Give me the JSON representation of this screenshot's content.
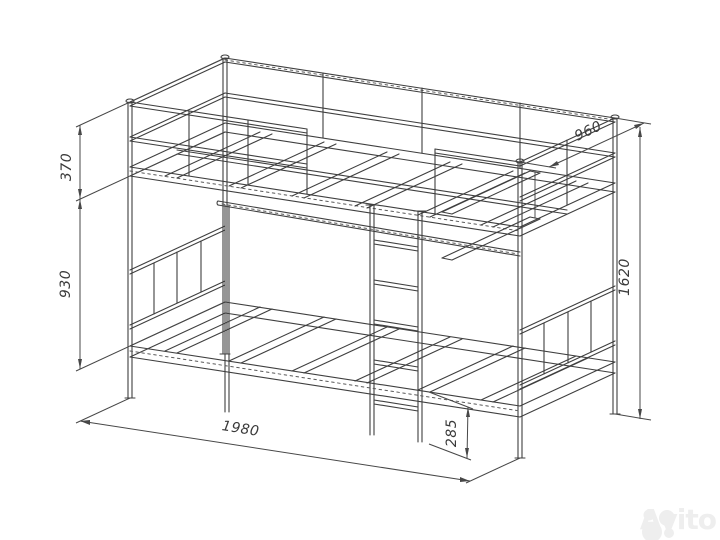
{
  "diagram": {
    "subject": "bunk-bed-technical-drawing",
    "colors": {
      "line": "#3f3f3f",
      "background": "#ffffff",
      "watermark": "#eeeeee"
    },
    "dimensions_mm": [
      {
        "id": "upper-guard-section-height",
        "label": "370",
        "orientation": "vertical",
        "position": "left-upper"
      },
      {
        "id": "between-bunks-height",
        "label": "930",
        "orientation": "vertical",
        "position": "left-lower"
      },
      {
        "id": "bed-depth",
        "label": "960",
        "orientation": "diagonal",
        "position": "top-right"
      },
      {
        "id": "overall-height",
        "label": "1620",
        "orientation": "vertical",
        "position": "right"
      },
      {
        "id": "bed-length",
        "label": "1980",
        "orientation": "diagonal",
        "position": "bottom"
      },
      {
        "id": "lower-bunk-frame-height",
        "label": "285",
        "orientation": "vertical",
        "position": "bottom-center"
      }
    ]
  },
  "watermark": {
    "text": "Avito"
  }
}
